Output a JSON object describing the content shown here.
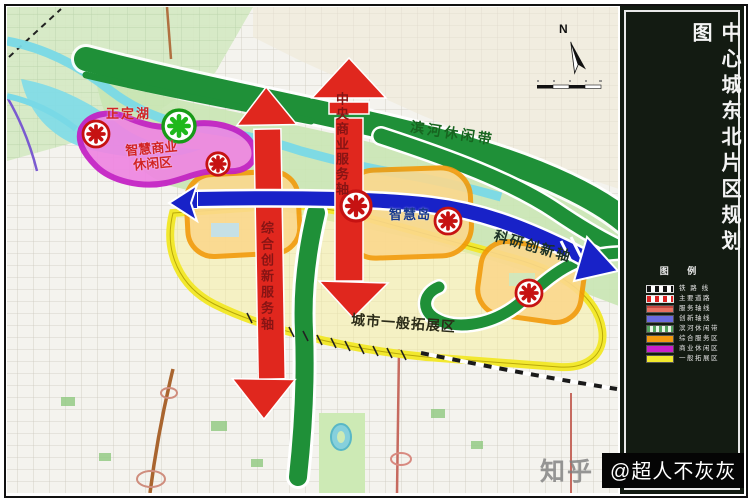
{
  "panel": {
    "title": "中心城东北片区规划图",
    "legend_title": "图 例",
    "legend": [
      {
        "label": "铁 路 线",
        "type": "railway",
        "color": "#ffffff"
      },
      {
        "label": "主要道路",
        "type": "road",
        "color": "#ffffff"
      },
      {
        "label": "服务轴线",
        "type": "fill",
        "color": "#e87060"
      },
      {
        "label": "创新轴线",
        "type": "fill",
        "color": "#6a6ae0"
      },
      {
        "label": "滨河休闲带",
        "type": "stripes",
        "color": "#55a45f"
      },
      {
        "label": "综合服务区",
        "type": "fill",
        "color": "#f29a10"
      },
      {
        "label": "商业休闲区",
        "type": "fill",
        "color": "#cb1fcb"
      },
      {
        "label": "一般拓展区",
        "type": "fill",
        "color": "#f2e82e"
      }
    ]
  },
  "map": {
    "north": "N",
    "labels": {
      "lake": "正定湖",
      "business_zone_line1": "智慧商业",
      "business_zone_line2": "休闲区",
      "riverside_belt": "滨河休闲带",
      "central_axis": "中央商业服务轴",
      "comprehensive_axis": "综合创新服务轴",
      "smart_island": "智慧岛",
      "innovation_axis": "科研创新轴",
      "expansion_area": "城市一般拓展区"
    },
    "node_markers": {
      "red_count": 5,
      "green_count": 1
    }
  },
  "watermark": {
    "brand": "知乎",
    "author": "@超人不灰灰"
  },
  "colors": {
    "corridor_green": "#1f9038",
    "axis_blue": "#1822c8",
    "arrow_red": "#e0271e",
    "zone_magenta": "#c41ec4",
    "zone_orange": "#f29a0a",
    "zone_yellow": "#f2e82e",
    "river_cyan": "#79d9e6",
    "panel_bg": "#131b12"
  }
}
